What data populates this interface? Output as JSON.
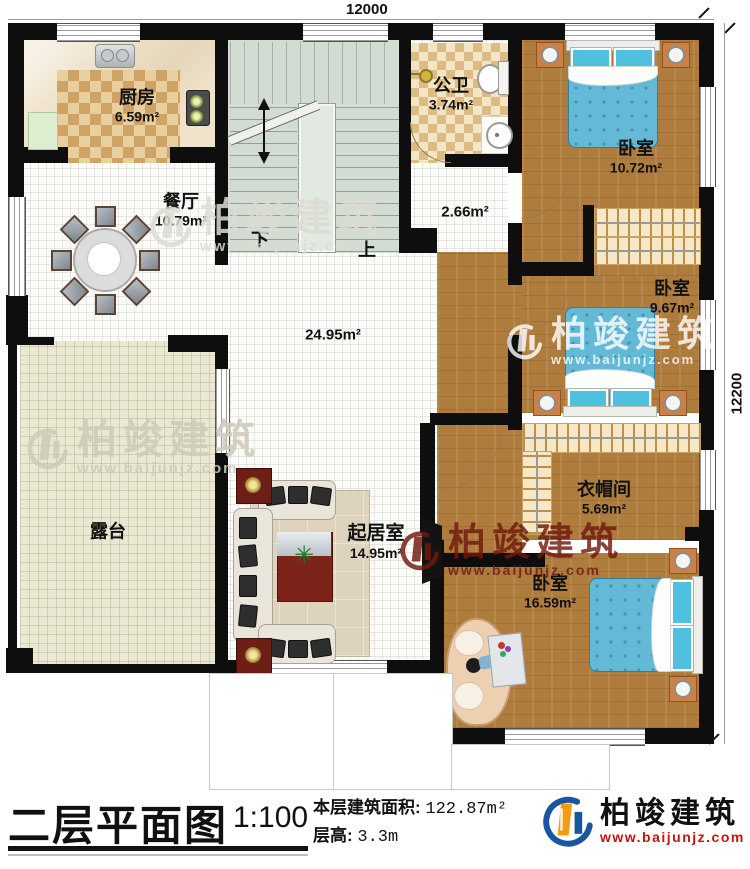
{
  "plan": {
    "dim_top": "12000",
    "dim_right": "12200",
    "rooms": {
      "kitchen": {
        "name": "厨房",
        "area": "6.59m²"
      },
      "dining": {
        "name": "餐厅",
        "area": "10.79m²"
      },
      "bath": {
        "name": "公卫",
        "area": "3.74m²"
      },
      "bedroom1": {
        "name": "卧室",
        "area": "10.72m²"
      },
      "bedroom2": {
        "name": "卧室",
        "area": "9.67m²"
      },
      "cloakroom": {
        "name": "衣帽间",
        "area": "5.69m²"
      },
      "bedroom3": {
        "name": "卧室",
        "area": "16.59m²"
      },
      "living": {
        "name": "起居室",
        "area": "14.95m²"
      },
      "terrace": {
        "name": "露台"
      },
      "hall": {
        "area": "24.95m²"
      },
      "corridor": {
        "area": "2.66m²"
      }
    },
    "stairs": {
      "down": "下",
      "up": "上"
    }
  },
  "watermark": {
    "brand": "柏竣建筑",
    "url": "www.baijunjz.com"
  },
  "titlebar": {
    "title": "二层平面图",
    "scale": "1:100",
    "area_label": "本层建筑面积:",
    "area_value": "122.87m²",
    "height_label": "层高:",
    "height_value": "3.3m",
    "brand": "柏竣建筑",
    "brand_url": "www.baijunjz.com"
  },
  "colors": {
    "wall": "#0e0e0e",
    "wood_floor": "#ae7c3c",
    "bed_blue": "#64bad6",
    "brand_blue": "#1a56a0",
    "brand_orange": "#f39c12",
    "url_red": "#cc1111",
    "watermark_red": "#7a1d12"
  }
}
